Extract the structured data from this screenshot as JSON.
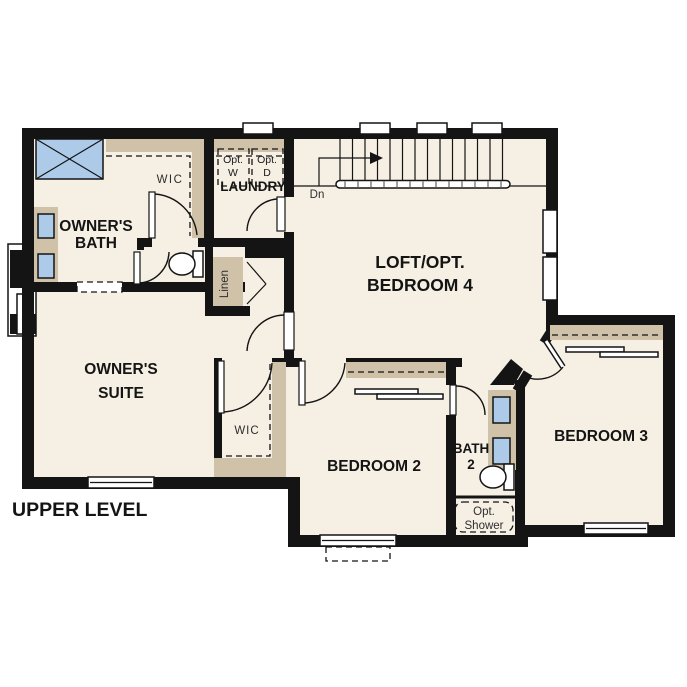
{
  "plan_title": "UPPER LEVEL",
  "colors": {
    "background": "#ffffff",
    "floor": "#f6efe3",
    "wall": "#141414",
    "cabinet_tan": "#cfc2a9",
    "fixture_blue": "#adcbe9",
    "appliance_gray": "#dcdcdc"
  },
  "labels": {
    "owners_bath": {
      "line1": "OWNER'S",
      "line2": "BATH"
    },
    "wic_bath": {
      "label": "WIC"
    },
    "laundry": {
      "label": "LAUNDRY"
    },
    "opt_washer": {
      "line1": "Opt.",
      "line2": "W"
    },
    "opt_dryer": {
      "line1": "Opt.",
      "line2": "D"
    },
    "stairs_down": {
      "label": "Dn"
    },
    "loft": {
      "line1": "LOFT/OPT.",
      "line2": "BEDROOM 4"
    },
    "linen": {
      "label": "Linen"
    },
    "owners_suite": {
      "line1": "OWNER'S",
      "line2": "SUITE"
    },
    "wic_suite": {
      "label": "WIC"
    },
    "bedroom2": {
      "label": "BEDROOM 2"
    },
    "bath2": {
      "line1": "BATH",
      "line2": "2"
    },
    "bedroom3": {
      "label": "BEDROOM 3"
    },
    "opt_shower": {
      "line1": "Opt.",
      "line2": "Shower"
    }
  }
}
